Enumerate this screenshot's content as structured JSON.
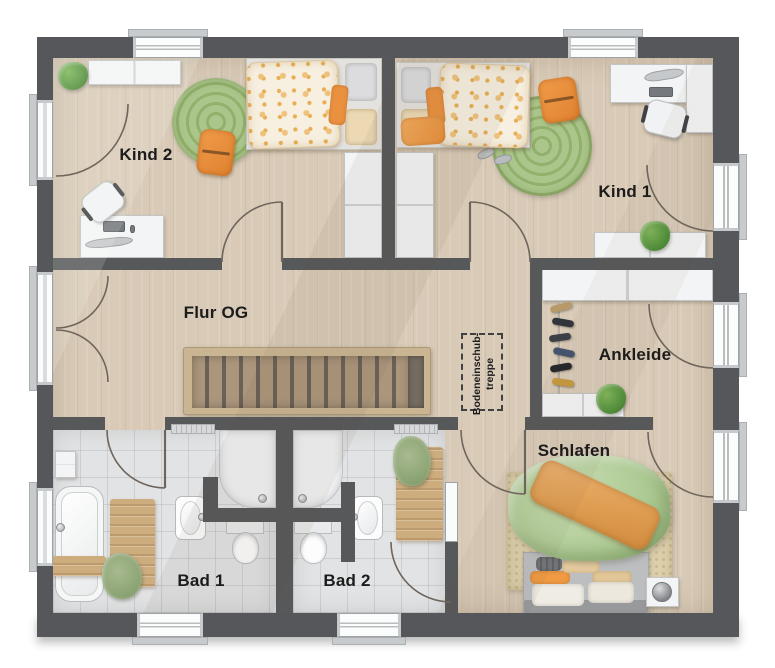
{
  "rooms": {
    "kind2": {
      "label": "Kind 2"
    },
    "kind1": {
      "label": "Kind 1"
    },
    "flur": {
      "label": "Flur OG"
    },
    "ankleide": {
      "label": "Ankleide"
    },
    "schlafen": {
      "label": "Schlafen"
    },
    "bad1": {
      "label": "Bad 1"
    },
    "bad2": {
      "label": "Bad 2"
    }
  },
  "annotations": {
    "attic_stairs_line1": "Bodeneinschub-",
    "attic_stairs_line2": "treppe"
  },
  "colors": {
    "wall": "#57585a",
    "wood_floor": "#d8cab6",
    "tile_floor": "#e2e3e4",
    "accent_orange": "#ec9140",
    "accent_green_rug": "#9db677",
    "duvet_green": "#b0cc96",
    "stair_wood": "#cab593"
  }
}
